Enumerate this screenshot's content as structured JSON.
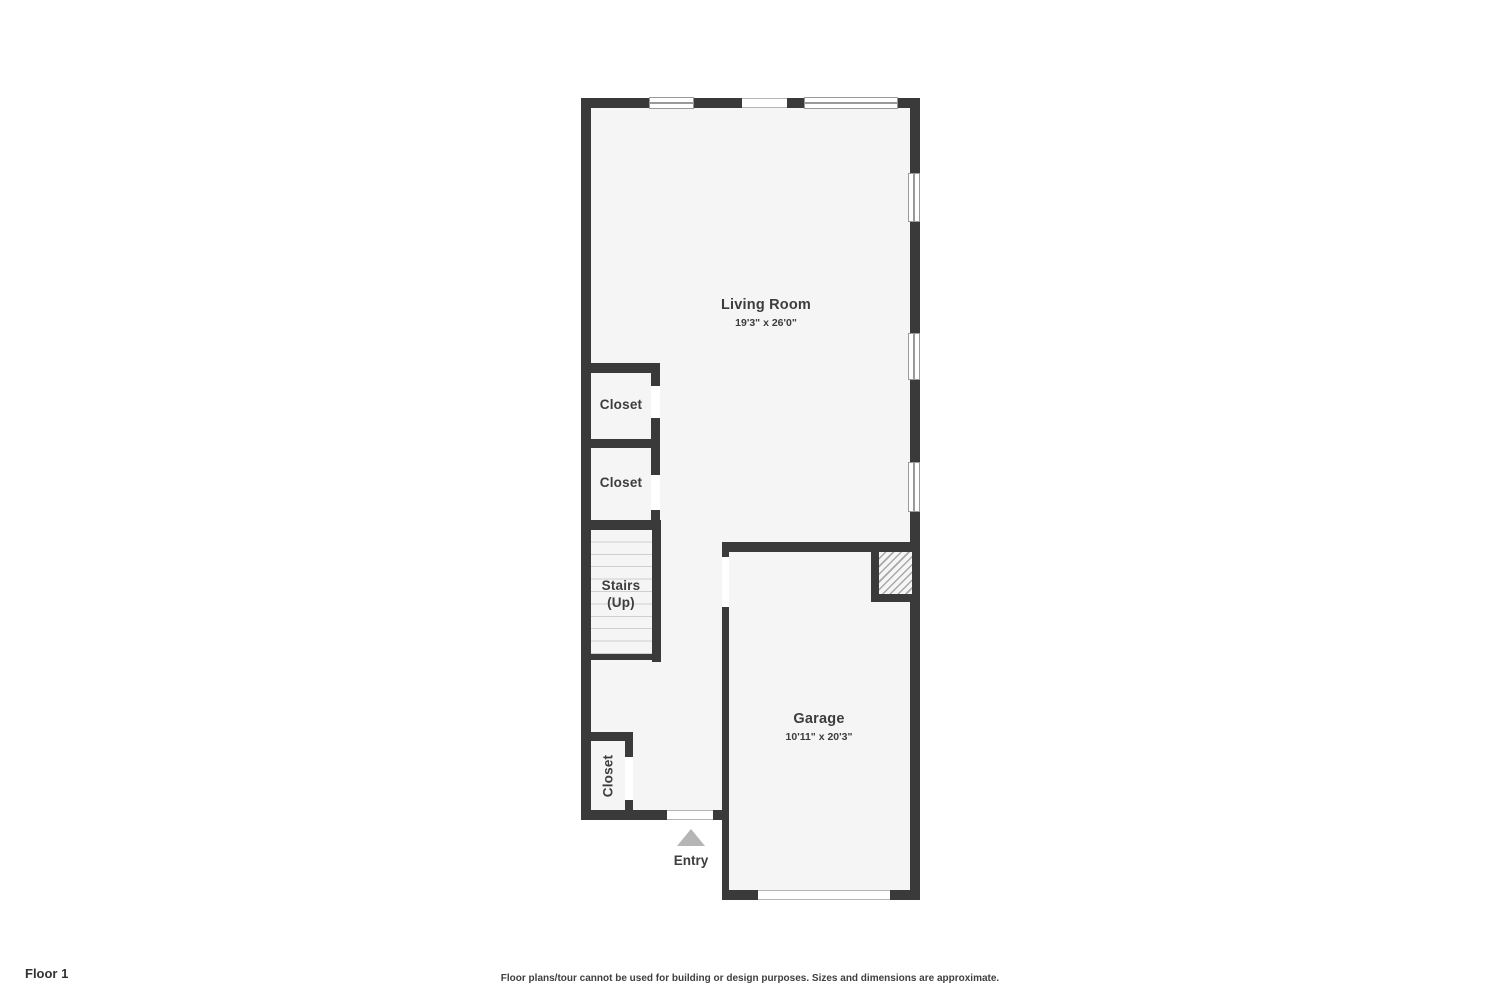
{
  "plan": {
    "floor_name": "Floor 1",
    "rooms": {
      "living_room": {
        "name": "Living Room",
        "dims": "19'3\" x 26'0\""
      },
      "closet_top": {
        "name": "Closet"
      },
      "closet_mid": {
        "name": "Closet"
      },
      "stairs": {
        "name": "Stairs",
        "sub": "(Up)"
      },
      "closet_entry": {
        "name": "Closet"
      },
      "garage": {
        "name": "Garage",
        "dims": "10'11\" x 20'3\""
      },
      "entry": {
        "name": "Entry"
      }
    },
    "colors": {
      "wall": "#3a3a3a",
      "floor": "#f5f5f5",
      "window_frame": "#9a9a9a",
      "entry_arrow": "#b5b5b5",
      "hatch_line": "#a8a8a8",
      "background": "#ffffff"
    }
  },
  "footer": {
    "floor_label": "Floor 1",
    "disclaimer": "Floor plans/tour cannot be used for building or design purposes. Sizes and dimensions are approximate."
  }
}
